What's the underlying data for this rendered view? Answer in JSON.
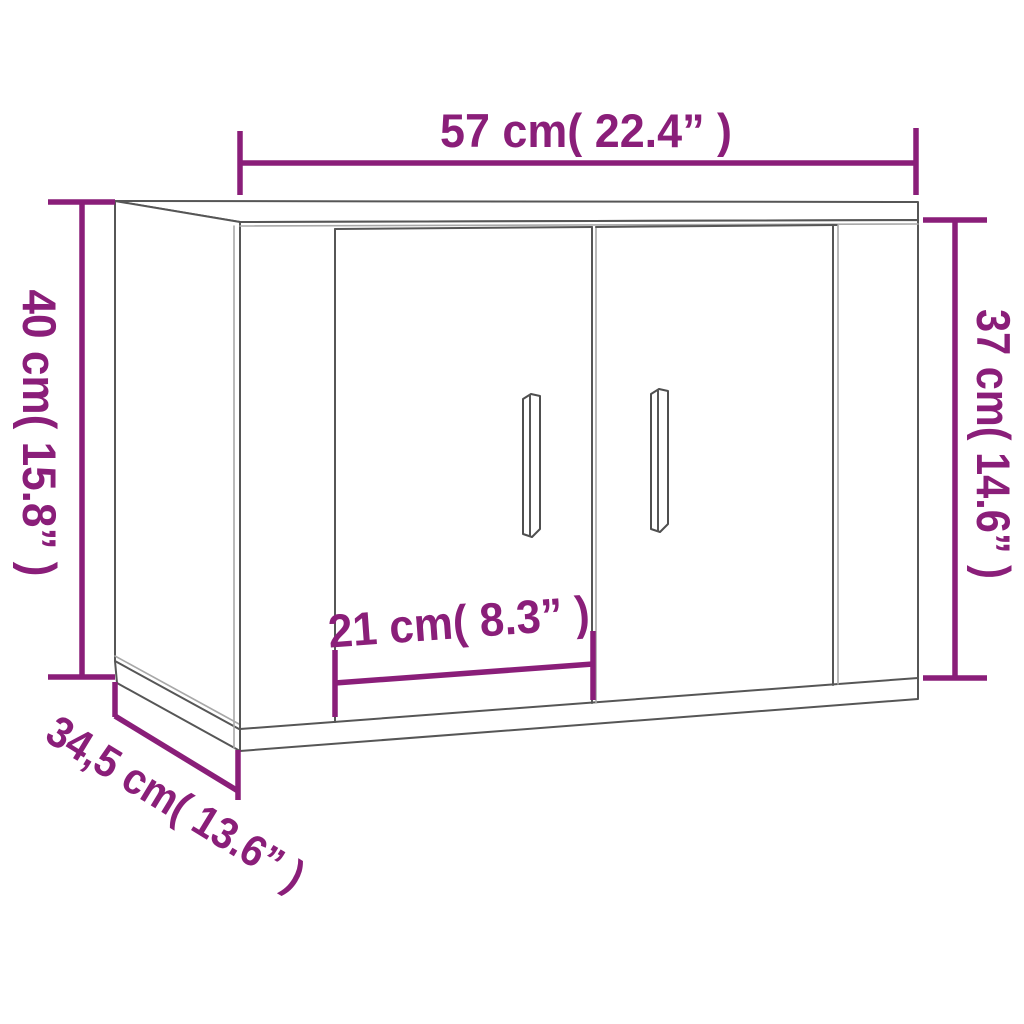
{
  "diagram": {
    "kind": "product-dimension-line-drawing",
    "subject": "wall-mounted cabinet with two doors and vertical bar handles",
    "colors": {
      "dimension_accent": "#8a1e79",
      "outline_dark": "#565656",
      "outline_light": "#a8a8a8",
      "surface": "#ffffff",
      "background": "#ffffff"
    },
    "dimensions": {
      "width": {
        "label": "57 cm( 22.4” )",
        "value_cm": "57",
        "value_inch": "22.4"
      },
      "height_back": {
        "label": "40 cm( 15.8” )",
        "value_cm": "40",
        "value_inch": "15.8"
      },
      "height_front": {
        "label": "37 cm( 14.6” )",
        "value_cm": "37",
        "value_inch": "14.6"
      },
      "door_width": {
        "label": "21 cm( 8.3” )",
        "value_cm": "21",
        "value_inch": "8.3"
      },
      "depth": {
        "label": "34,5 cm( 13.6” )",
        "value_cm": "34,5",
        "value_inch": "13.6"
      }
    }
  }
}
